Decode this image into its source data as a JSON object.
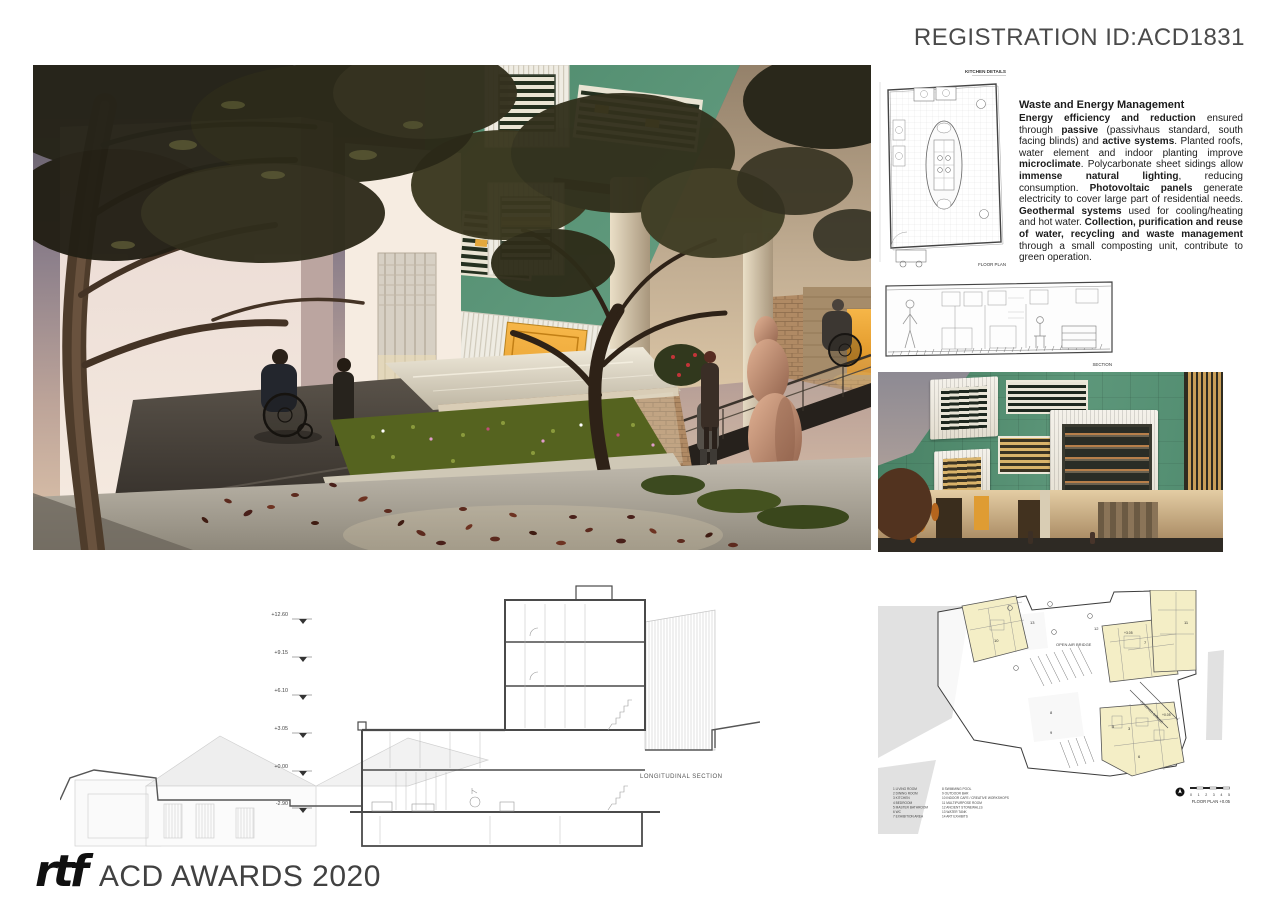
{
  "board": {
    "registration_id": "REGISTRATION ID:ACD1831"
  },
  "footer": {
    "logo_text": "rtf",
    "award_title": "ACD AWARDS 2020"
  },
  "energy_section": {
    "heading": "Waste and Energy Management",
    "paragraph": [
      {
        "t": "Energy efficiency and reduction",
        "b": true
      },
      {
        "t": " ensured through ",
        "b": false
      },
      {
        "t": "passive",
        "b": true
      },
      {
        "t": " (passivhaus standard, south facing blinds) and ",
        "b": false
      },
      {
        "t": "active systems",
        "b": true
      },
      {
        "t": ". Planted roofs, water element and indoor planting improve ",
        "b": false
      },
      {
        "t": "microclimate",
        "b": true
      },
      {
        "t": ". Polycarbonate sheet sidings allow ",
        "b": false
      },
      {
        "t": "immense natural lighting",
        "b": true
      },
      {
        "t": ", reducing consumption. ",
        "b": false
      },
      {
        "t": "Photovoltaic panels",
        "b": true
      },
      {
        "t": " generate electricity to cover large part of residential needs. ",
        "b": false
      },
      {
        "t": "Geothermal systems",
        "b": true
      },
      {
        "t": " used for cooling/heating and hot water. ",
        "b": false
      },
      {
        "t": "Collection, purification and reuse of water, recycling and waste management",
        "b": true
      },
      {
        "t": " through a small composting unit, contribute to green operation.",
        "b": false
      }
    ]
  },
  "kitchen_plan": {
    "title": "KITCHEN DETAILS",
    "caption": "FLOOR PLAN"
  },
  "kitchen_section": {
    "caption": "SECTION"
  },
  "longitudinal_section": {
    "caption": "LONGITUDINAL SECTION",
    "levels": [
      "+12.60",
      "+9.15",
      "+6.10",
      "+3.05",
      "+0.00",
      "-2.90"
    ]
  },
  "floor_plan": {
    "caption": "FLOOR PLAN  +0.05",
    "bridge_label": "OPEN AIR BRIDGE",
    "covered_label": "COVERED BRIDGE",
    "scale_numbers": "0 1 2 3 4 5",
    "level_tags": [
      "+3.05",
      "+0.05"
    ],
    "room_numbers": [
      "13",
      "12",
      "11",
      "10",
      "8",
      "9",
      "7",
      "1",
      "3",
      "5",
      "6"
    ],
    "legend_col1": [
      "1  LIVING ROOM",
      "2  DINING ROOM",
      "3  KITCHEN",
      "4  BEDROOM",
      "5  MASTER BATHROOM",
      "6  WC",
      "7  EXHIBITION AREA"
    ],
    "legend_col2": [
      "8  SWIMMING POOL",
      "9  OUTDOOR BAR",
      "10  INDOOR CAFE / CREATIVE WORKSHOPS",
      "11  MULTIPURPOSE ROOM",
      "12  ANCIENT STONEWALLS",
      "13  WATER TANK",
      "14  ART EXHIBITS"
    ]
  },
  "colors": {
    "facade_green": "#55906f",
    "plan_yellow": "#f4eec6",
    "door_orange": "#e8a02b",
    "stone_brown": "#b08a64",
    "sky_dusk": "#8d808b"
  }
}
